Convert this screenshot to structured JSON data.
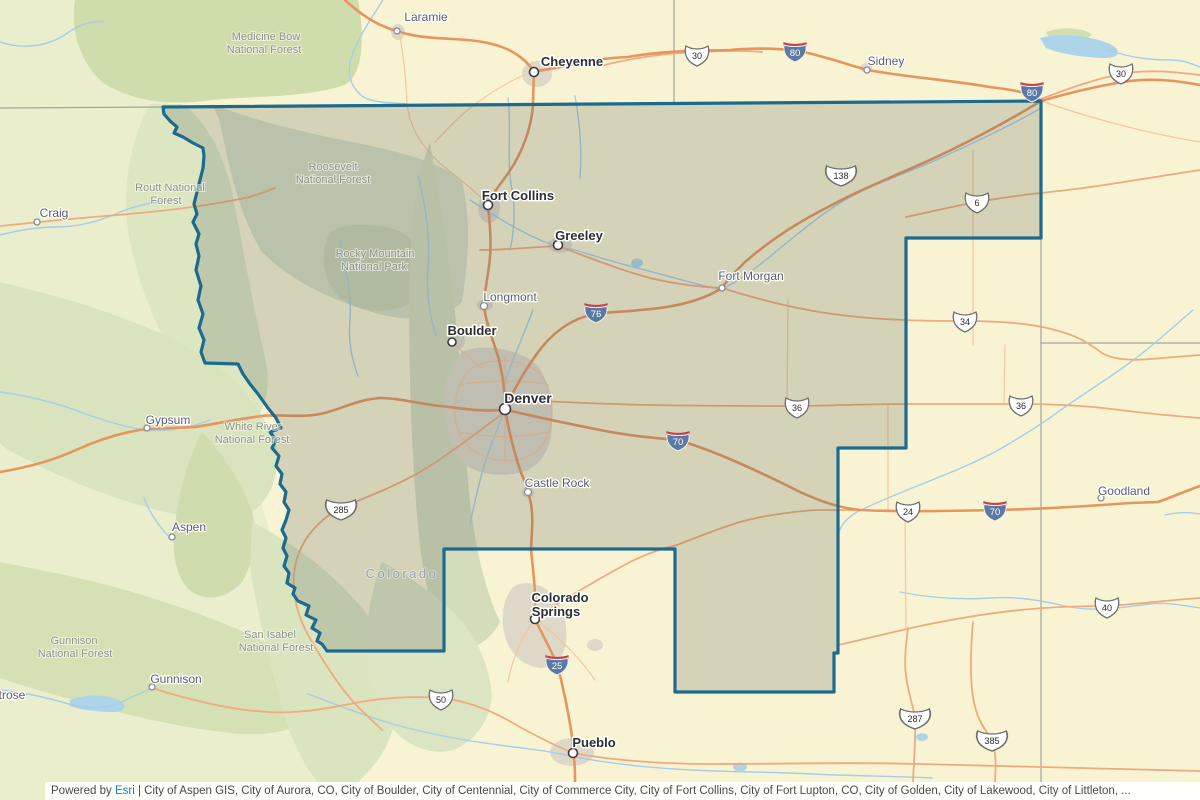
{
  "attribution": {
    "powered_by": "Powered by",
    "esri_link": "Esri",
    "separator": "|",
    "sources": "City of Aspen GIS, City of Aurora, CO, City of Boulder, City of Centennial, City of Commerce City, City of Fort Collins, City of Fort Lupton, CO, City of Golden, City of Lakewood, City of Littleton, ..."
  },
  "state_label": "Colorado",
  "cities": {
    "cheyenne": "Cheyenne",
    "laramie": "Laramie",
    "sidney": "Sidney",
    "fort_collins": "Fort Collins",
    "greeley": "Greeley",
    "fort_morgan": "Fort Morgan",
    "longmont": "Longmont",
    "boulder": "Boulder",
    "denver": "Denver",
    "castle_rock": "Castle Rock",
    "colorado_springs_1": "Colorado",
    "colorado_springs_2": "Springs",
    "pueblo": "Pueblo",
    "craig": "Craig",
    "gypsum": "Gypsum",
    "aspen": "Aspen",
    "gunnison": "Gunnison",
    "goodland": "Goodland",
    "montrose_partial": "trose"
  },
  "forests": {
    "medicine_bow_1": "Medicine Bow",
    "medicine_bow_2": "National Forest",
    "routt_1": "Routt National",
    "routt_2": "Forest",
    "roosevelt_1": "Roosevelt",
    "roosevelt_2": "National Forest",
    "rmnp_1": "Rocky Mountain",
    "rmnp_2": "National Park",
    "white_river_1": "White River",
    "white_river_2": "National Forest",
    "san_isabel_1": "San Isabel",
    "san_isabel_2": "National Forest",
    "gunnison_nf_1": "Gunnison",
    "gunnison_nf_2": "National Forest"
  },
  "shields": {
    "i80": "80",
    "i76": "76",
    "i70": "70",
    "i25": "25",
    "us30": "30",
    "us138": "138",
    "us6": "6",
    "us34": "34",
    "us36": "36",
    "us24": "24",
    "us40": "40",
    "us285": "285",
    "us50": "50",
    "us287": "287",
    "us385": "385"
  },
  "colors": {
    "boundary": "#1d6a8f",
    "plains": "#f8f4d3",
    "road_orange": "#e6955f",
    "river_blue": "#a6cee6",
    "interstate_blue": "#5b79a5",
    "interstate_red": "#c5414b",
    "esri_link_blue": "#1a7db6"
  }
}
